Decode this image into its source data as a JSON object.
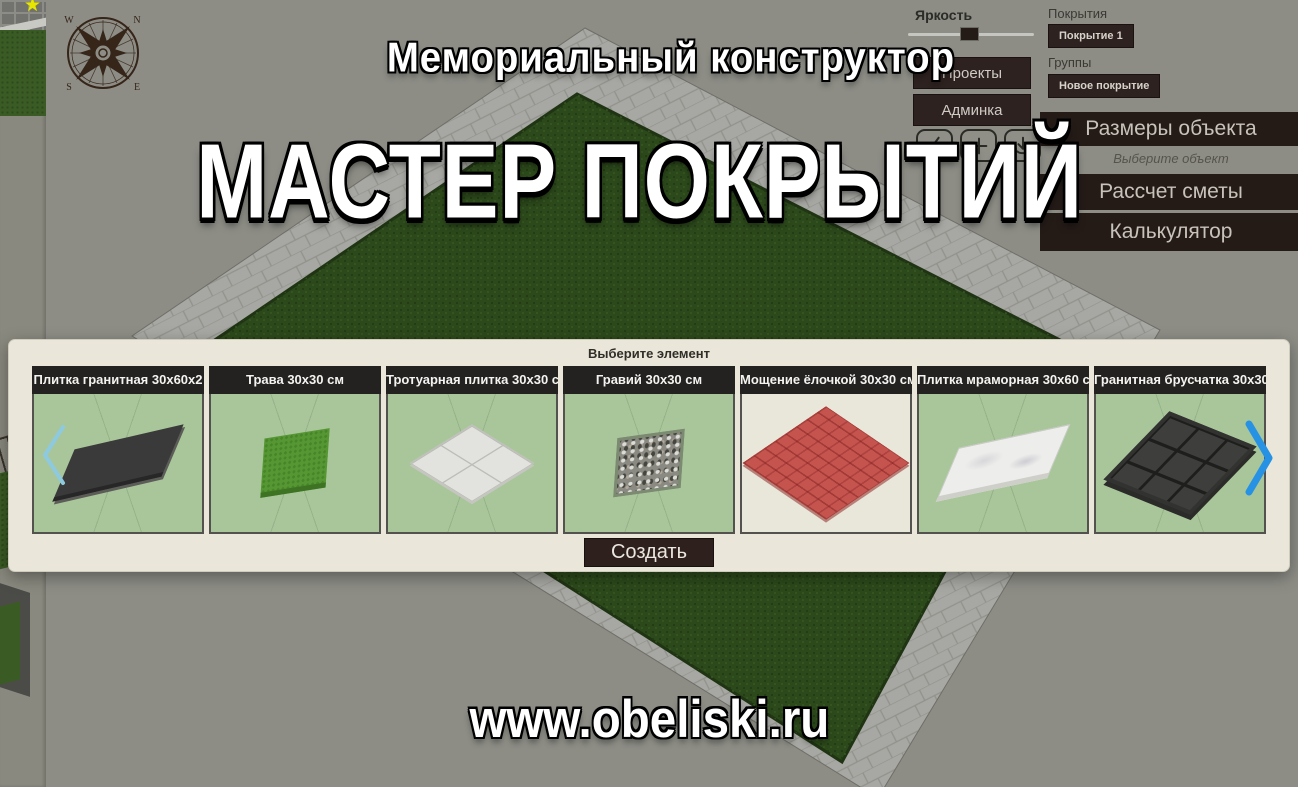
{
  "branding": {
    "app_subtitle": "Мемориальный конструктор",
    "app_title": "МАСТЕР ПОКРЫТИЙ",
    "website": "www.obeliski.ru"
  },
  "toolbar": {
    "brightness_label": "Яркость",
    "projects_button": "Проекты",
    "admin_button": "Админка",
    "icon_buttons": [
      {
        "icon": "broom-icon"
      },
      {
        "icon": "plus-icon"
      },
      {
        "icon": "download-icon"
      }
    ]
  },
  "coatings_panel": {
    "coatings_label": "Покрытия",
    "coating_item": "Покрытие 1",
    "groups_label": "Группы",
    "new_coating_button": "Новое покрытие",
    "object_sizes_header": "Размеры объекта",
    "select_object_hint": "Выберите объект",
    "estimate_header": "Рассчет сметы",
    "calculator_header": "Калькулятор"
  },
  "element_picker": {
    "header": "Выберите элемент",
    "create_button": "Создать",
    "items": [
      {
        "label": "Плитка гранитная 30х60х2"
      },
      {
        "label": "Трава 30х30 см"
      },
      {
        "label": "Тротуарная плитка 30х30 см"
      },
      {
        "label": "Гравий 30х30 см"
      },
      {
        "label": "Мощение ёлочкой 30х30 см"
      },
      {
        "label": "Плитка мраморная 30х60 см"
      },
      {
        "label": "Гранитная брусчатка 30х30"
      }
    ]
  },
  "scene": {
    "compass_labels": {
      "nw": "W",
      "ne": "N",
      "sw": "S",
      "se": "E"
    }
  },
  "colors": {
    "accent_brown": "#2e2220",
    "bar_brown": "#241b17",
    "panel_cream": "#eae6da",
    "grass_green": "#2c491b",
    "tile_green_bg": "#a9c69b",
    "nav_prev_blue": "#8ecadf",
    "nav_next_blue": "#2792e4",
    "marker_yellow": "#e6e600"
  }
}
